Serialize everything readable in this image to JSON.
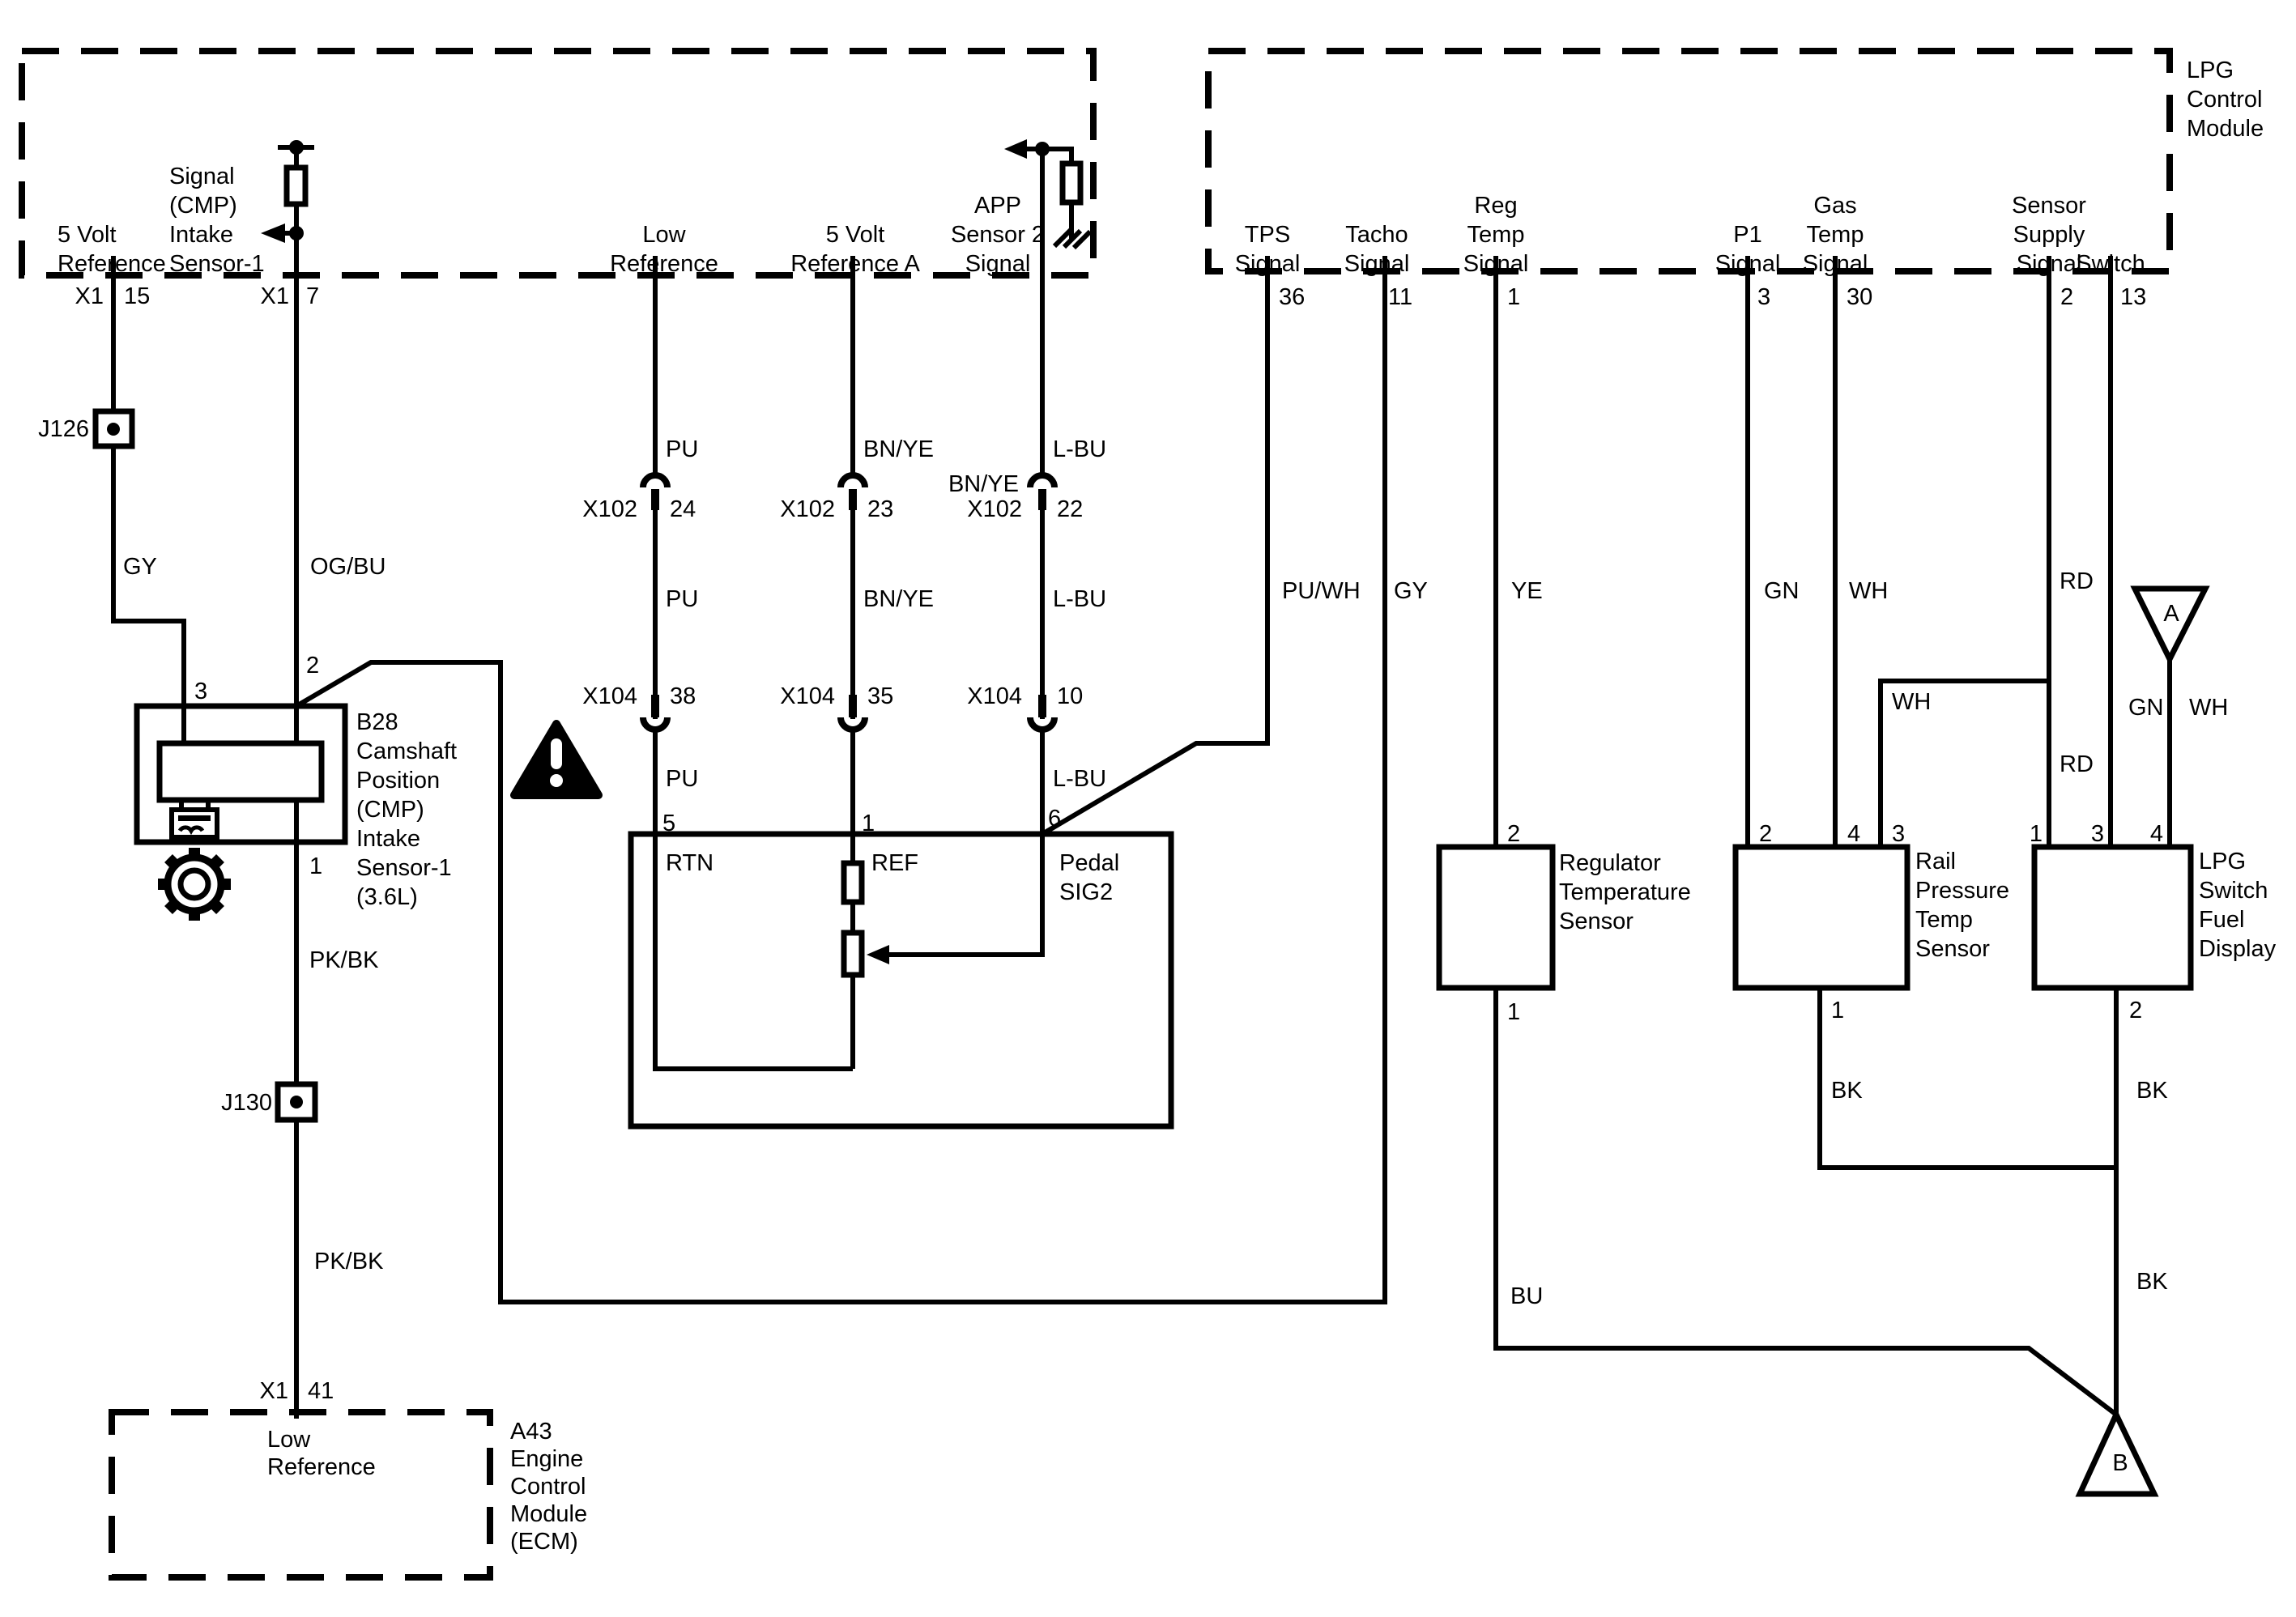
{
  "diagram": {
    "colors": {
      "ink": "#000000",
      "background": "#ffffff"
    },
    "tl_module": {
      "t_5vref": {
        "l1": "5 Volt",
        "l2": "Reference",
        "conn": "X1",
        "pin": "15"
      },
      "t_cmp": {
        "l1": "Signal",
        "l2": "(CMP)",
        "l3": "Intake",
        "l4": "Sensor-1",
        "conn": "X1",
        "pin": "7"
      },
      "t_lowref": {
        "l1": "Low",
        "l2": "Reference"
      },
      "t_5vrefa": {
        "l1": "5 Volt",
        "l2": "Reference A"
      },
      "t_app": {
        "l1": "APP",
        "l2": "Sensor 2",
        "l3": "Signal"
      }
    },
    "lpg_module": {
      "name_l1": "LPG",
      "name_l2": "Control",
      "name_l3": "Module",
      "t_tps": {
        "l1": "TPS",
        "l2": "Signal",
        "pin": "36"
      },
      "t_tacho": {
        "l1": "Tacho",
        "l2": "Signal",
        "pin": "11"
      },
      "t_regtemp": {
        "l1": "Reg",
        "l2": "Temp",
        "l3": "Signal",
        "pin": "1"
      },
      "t_p1": {
        "l1": "P1",
        "l2": "Signal",
        "pin": "3"
      },
      "t_gastemp": {
        "l1": "Gas",
        "l2": "Temp",
        "l3": "Signal",
        "pin": "30"
      },
      "t_senssup": {
        "l1": "Sensor",
        "l2": "Supply",
        "l3": "Signal",
        "pin": "2"
      },
      "t_switch": {
        "l1": "Switch",
        "pin": "13"
      }
    },
    "ecm_module": {
      "name_l1": "A43",
      "name_l2": "Engine",
      "name_l3": "Control",
      "name_l4": "Module",
      "name_l5": "(ECM)",
      "term": {
        "l1": "Low",
        "l2": "Reference",
        "conn": "X1",
        "pin": "41"
      }
    },
    "b28": {
      "name_l1": "B28",
      "name_l2": "Camshaft",
      "name_l3": "Position",
      "name_l4": "(CMP)",
      "name_l5": "Intake",
      "name_l6": "Sensor-1",
      "name_l7": "(3.6L)",
      "pin3": "3",
      "pin2": "2",
      "pin1": "1"
    },
    "pedal": {
      "pin5": "5",
      "pin1": "1",
      "pin6": "6",
      "rtn": "RTN",
      "ref": "REF",
      "sig_l1": "Pedal",
      "sig_l2": "SIG2"
    },
    "regulator": {
      "name_l1": "Regulator",
      "name_l2": "Temperature",
      "name_l3": "Sensor",
      "pin_top": "2",
      "pin_bottom": "1"
    },
    "rail": {
      "name_l1": "Rail",
      "name_l2": "Pressure",
      "name_l3": "Temp",
      "name_l4": "Sensor",
      "pin_a": "2",
      "pin_b": "4",
      "pin_c": "3",
      "pin_bottom": "1"
    },
    "fuel_display": {
      "name_l1": "LPG",
      "name_l2": "Switch",
      "name_l3": "Fuel",
      "name_l4": "Display",
      "pin_a": "1",
      "pin_b": "3",
      "pin_c": "4",
      "pin_bottom": "2"
    },
    "x102": {
      "name": "X102",
      "pin_a": "24",
      "pin_b": "23",
      "pin_c": "22"
    },
    "x104": {
      "name": "X104",
      "pin_a": "38",
      "pin_b": "35",
      "pin_c": "10"
    },
    "splices": {
      "j126": "J126",
      "j130": "J130"
    },
    "offpage_a": "A",
    "offpage_b": "B",
    "wire_colors": {
      "gy1": "GY",
      "ogbu": "OG/BU",
      "pu1": "PU",
      "bnye1": "BN/YE",
      "lbu1": "L-BU",
      "bnye_x102": "BN/YE",
      "pu2": "PU",
      "bnye2": "BN/YE",
      "lbu2": "L-BU",
      "pu3": "PU",
      "lbu3": "L-BU",
      "puwh": "PU/WH",
      "gy2": "GY",
      "ye": "YE",
      "gn1": "GN",
      "wh1": "WH",
      "rd1": "RD",
      "wh_jumper": "WH",
      "rd2": "RD",
      "gn2": "GN",
      "wh2": "WH",
      "pkbk1": "PK/BK",
      "pkbk2": "PK/BK",
      "bu": "BU",
      "bk1": "BK",
      "bk2": "BK",
      "bk3": "BK"
    }
  }
}
